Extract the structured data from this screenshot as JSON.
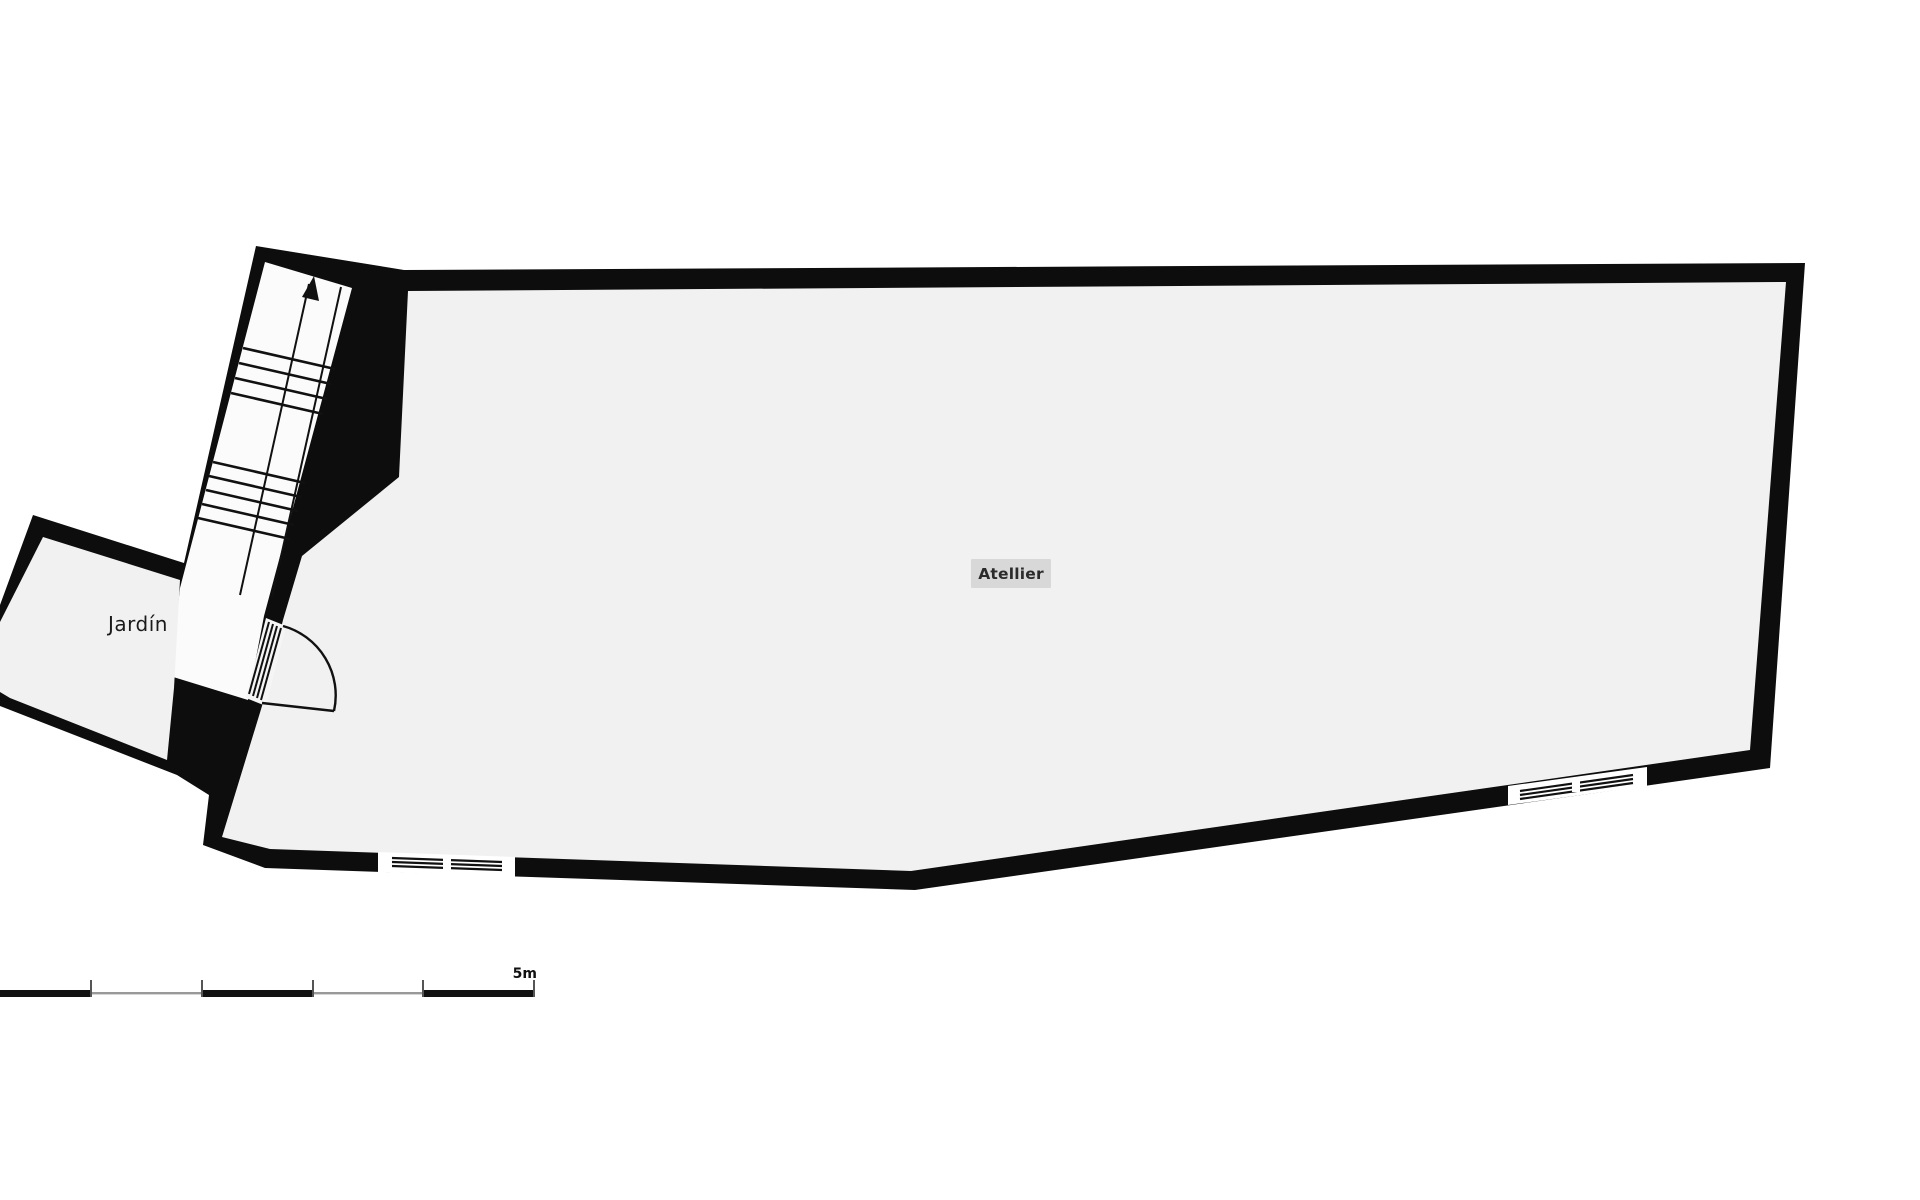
{
  "plan": {
    "title": "floor-plan",
    "rooms": [
      {
        "id": "atelier",
        "label": "Atellier"
      },
      {
        "id": "jardin",
        "label": "Jardín"
      }
    ],
    "stairs": {
      "direction": "up",
      "arrow": "up-arrow"
    },
    "scale_bar": {
      "label": "5m",
      "total_meters": 5,
      "segments": 5
    },
    "colors": {
      "wall": "#0d0d0d",
      "room_fill": "#f1f1f1",
      "stair_fill": "#fbfbfb",
      "page_bg": "#ffffff",
      "atelier_label_bg": "#d8d8d8",
      "atelier_label_text": "#2b2b2b",
      "jardin_label_text": "#1b1b1b",
      "scale_gray": "#999999",
      "line": "#111111"
    }
  }
}
